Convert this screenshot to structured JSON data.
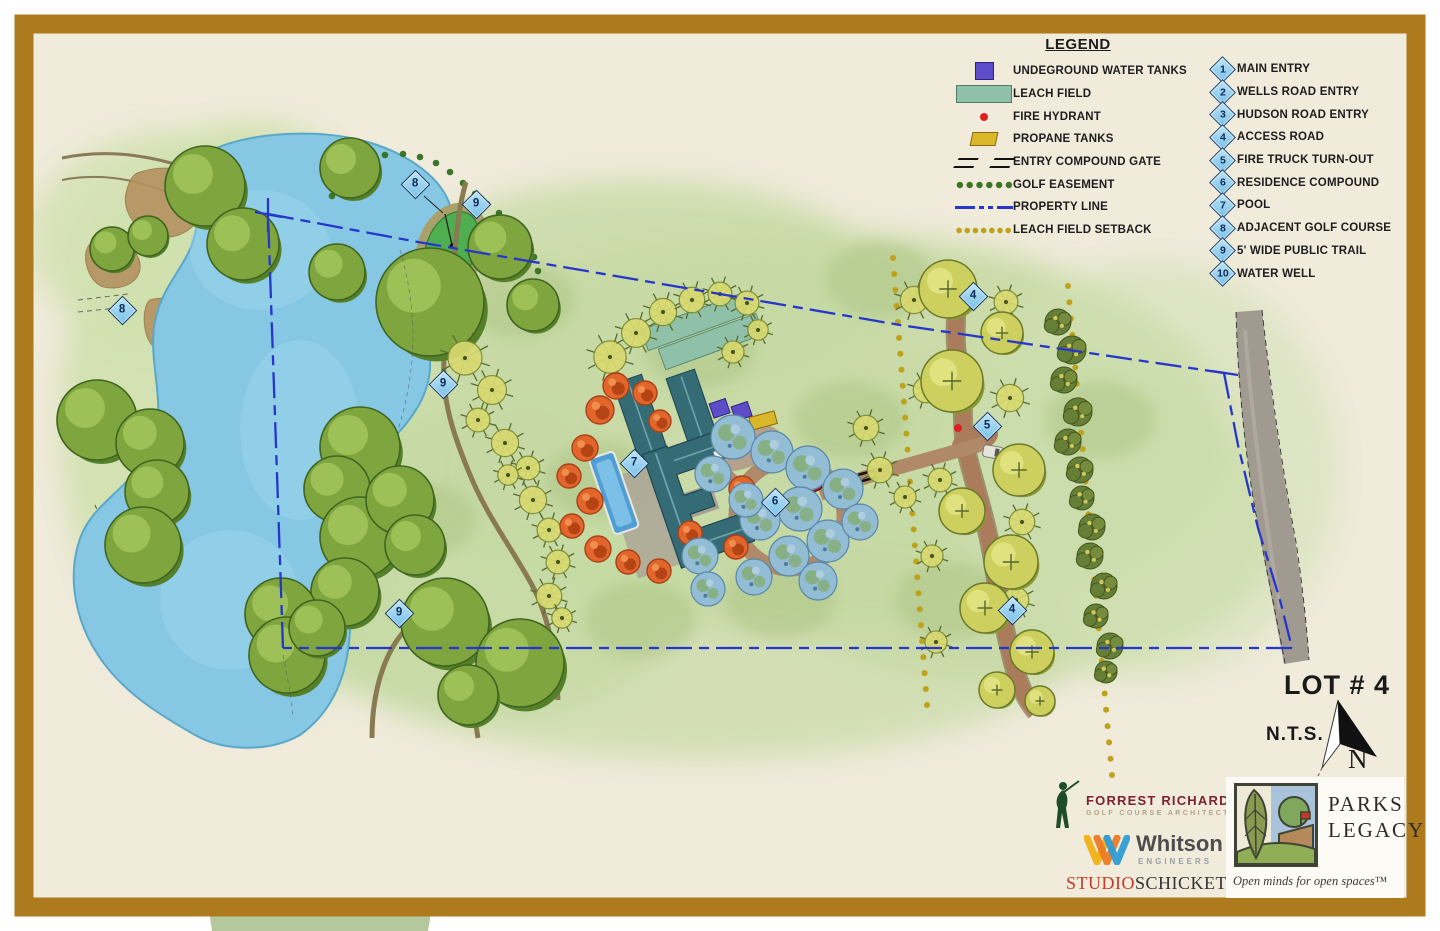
{
  "legend": {
    "title": "LEGEND",
    "symbol_items": [
      {
        "label": "UNDEGROUND WATER TANKS",
        "symbol": "water-tank"
      },
      {
        "label": "LEACH FIELD",
        "symbol": "leach-field"
      },
      {
        "label": "FIRE HYDRANT",
        "symbol": "fire-hydrant"
      },
      {
        "label": "PROPANE TANKS",
        "symbol": "propane-tanks"
      },
      {
        "label": "ENTRY COMPOUND GATE",
        "symbol": "entry-compound-gate"
      },
      {
        "label": "GOLF EASEMENT",
        "symbol": "golf-easement"
      },
      {
        "label": "PROPERTY LINE",
        "symbol": "property-line"
      },
      {
        "label": "LEACH FIELD SETBACK",
        "symbol": "leach-field-setback"
      }
    ],
    "numbered_items": [
      {
        "number": "1",
        "label": "MAIN ENTRY"
      },
      {
        "number": "2",
        "label": "WELLS ROAD ENTRY"
      },
      {
        "number": "3",
        "label": "HUDSON ROAD ENTRY"
      },
      {
        "number": "4",
        "label": "ACCESS ROAD"
      },
      {
        "number": "5",
        "label": "FIRE TRUCK TURN-OUT"
      },
      {
        "number": "6",
        "label": "RESIDENCE COMPOUND"
      },
      {
        "number": "7",
        "label": "POOL"
      },
      {
        "number": "8",
        "label": "ADJACENT GOLF COURSE"
      },
      {
        "number": "9",
        "label": "5' WIDE PUBLIC TRAIL"
      },
      {
        "number": "10",
        "label": "WATER WELL"
      }
    ]
  },
  "map": {
    "markers": [
      {
        "number": "8",
        "x": 125,
        "y": 313
      },
      {
        "number": "8",
        "x": 418,
        "y": 187
      },
      {
        "number": "9",
        "x": 479,
        "y": 207
      },
      {
        "number": "9",
        "x": 446,
        "y": 387
      },
      {
        "number": "9",
        "x": 402,
        "y": 616
      },
      {
        "number": "7",
        "x": 637,
        "y": 466
      },
      {
        "number": "6",
        "x": 778,
        "y": 505
      },
      {
        "number": "5",
        "x": 990,
        "y": 429
      },
      {
        "number": "4",
        "x": 976,
        "y": 299
      },
      {
        "number": "4",
        "x": 1015,
        "y": 613
      }
    ]
  },
  "annotations": {
    "lot_label": "LOT # 4",
    "scale_label": "N.T.S.",
    "north_label": "N"
  },
  "logos": {
    "forrest": {
      "line1": "FORREST RICHARDSON",
      "line2": "GOLF COURSE ARCHITECTS"
    },
    "whitson": {
      "name": "Whitson",
      "sub": "ENGINEERS"
    },
    "studio": {
      "part1": "STUDIO",
      "part2": "SCHICKETANZ"
    },
    "parks": {
      "line1": "PARKS",
      "line2": "LEGACY",
      "tagline": "Open minds for open spaces™"
    }
  },
  "colors": {
    "frame": "#ad7a1e",
    "paper": "#f0ebdb",
    "pond": "#86c8e3",
    "property_line": "#2636cc",
    "marker_fill": "#8fd0ee",
    "marker_border": "#1c3f6e",
    "water_tank": "#5f4cc9",
    "leach_field": "#8fc0a8",
    "propane": "#d9b728",
    "fire_hydrant": "#e02020",
    "golf_easement": "#3c7526",
    "leach_setback": "#bfa21c",
    "building": "#356b74",
    "access_road": "#ab7c5c",
    "paved_road": "#a09a90"
  }
}
